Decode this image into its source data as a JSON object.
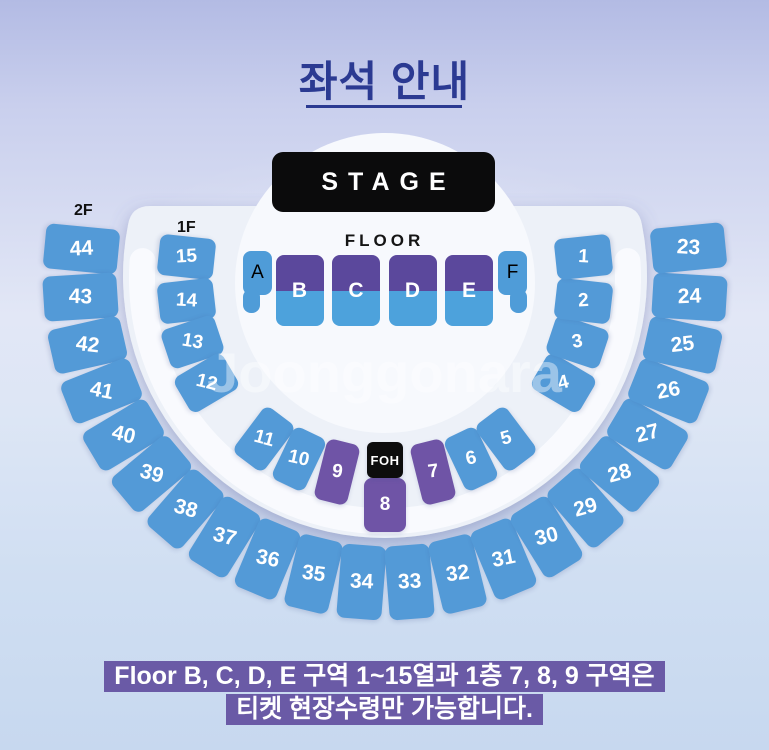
{
  "title": {
    "text": "좌석 안내"
  },
  "stage": {
    "label": "STAGE"
  },
  "floor": {
    "label": "FLOOR",
    "sections": [
      {
        "label": "A",
        "type": "tabL"
      },
      {
        "label": "B",
        "type": "split"
      },
      {
        "label": "C",
        "type": "split"
      },
      {
        "label": "D",
        "type": "split"
      },
      {
        "label": "E",
        "type": "split"
      },
      {
        "label": "F",
        "type": "tabR"
      }
    ]
  },
  "levels": {
    "second_floor_label": "2F",
    "first_floor_label": "1F"
  },
  "foh": {
    "label": "FOH"
  },
  "rings": {
    "outer_2f": [
      "44",
      "43",
      "42",
      "41",
      "40",
      "39",
      "38",
      "37",
      "36",
      "35",
      "34",
      "33",
      "32",
      "31",
      "30",
      "29",
      "28",
      "27",
      "26",
      "25",
      "24",
      "23"
    ],
    "inner_1f": [
      "15",
      "14",
      "13",
      "12",
      "11",
      "10",
      "9",
      "8",
      "7",
      "6",
      "5",
      "4",
      "3",
      "2",
      "1"
    ],
    "purple_sections": [
      "9",
      "8",
      "7"
    ]
  },
  "watermark": {
    "text": "Joonggonara"
  },
  "notice": {
    "line1": "Floor B, C, D, E 구역 1~15열과 1층 7, 8, 9 구역은",
    "line2": "티켓 현장수령만 가능합니다."
  },
  "colors": {
    "seat_blue": "#539ad7",
    "section_purple": "#6f54a6",
    "floor_purple": "#5b489c",
    "floor_blue": "#4da2dc",
    "floor_side_blue": "#4f9cd8",
    "stage_bg": "#0b0b0c",
    "foh_bg": "#0d0d0d",
    "notice_bg": "#6a5aa6",
    "title_navy": "#2b3a92",
    "fan_white": "#edf1f8",
    "inner_disc_white": "#f7f9fd"
  }
}
